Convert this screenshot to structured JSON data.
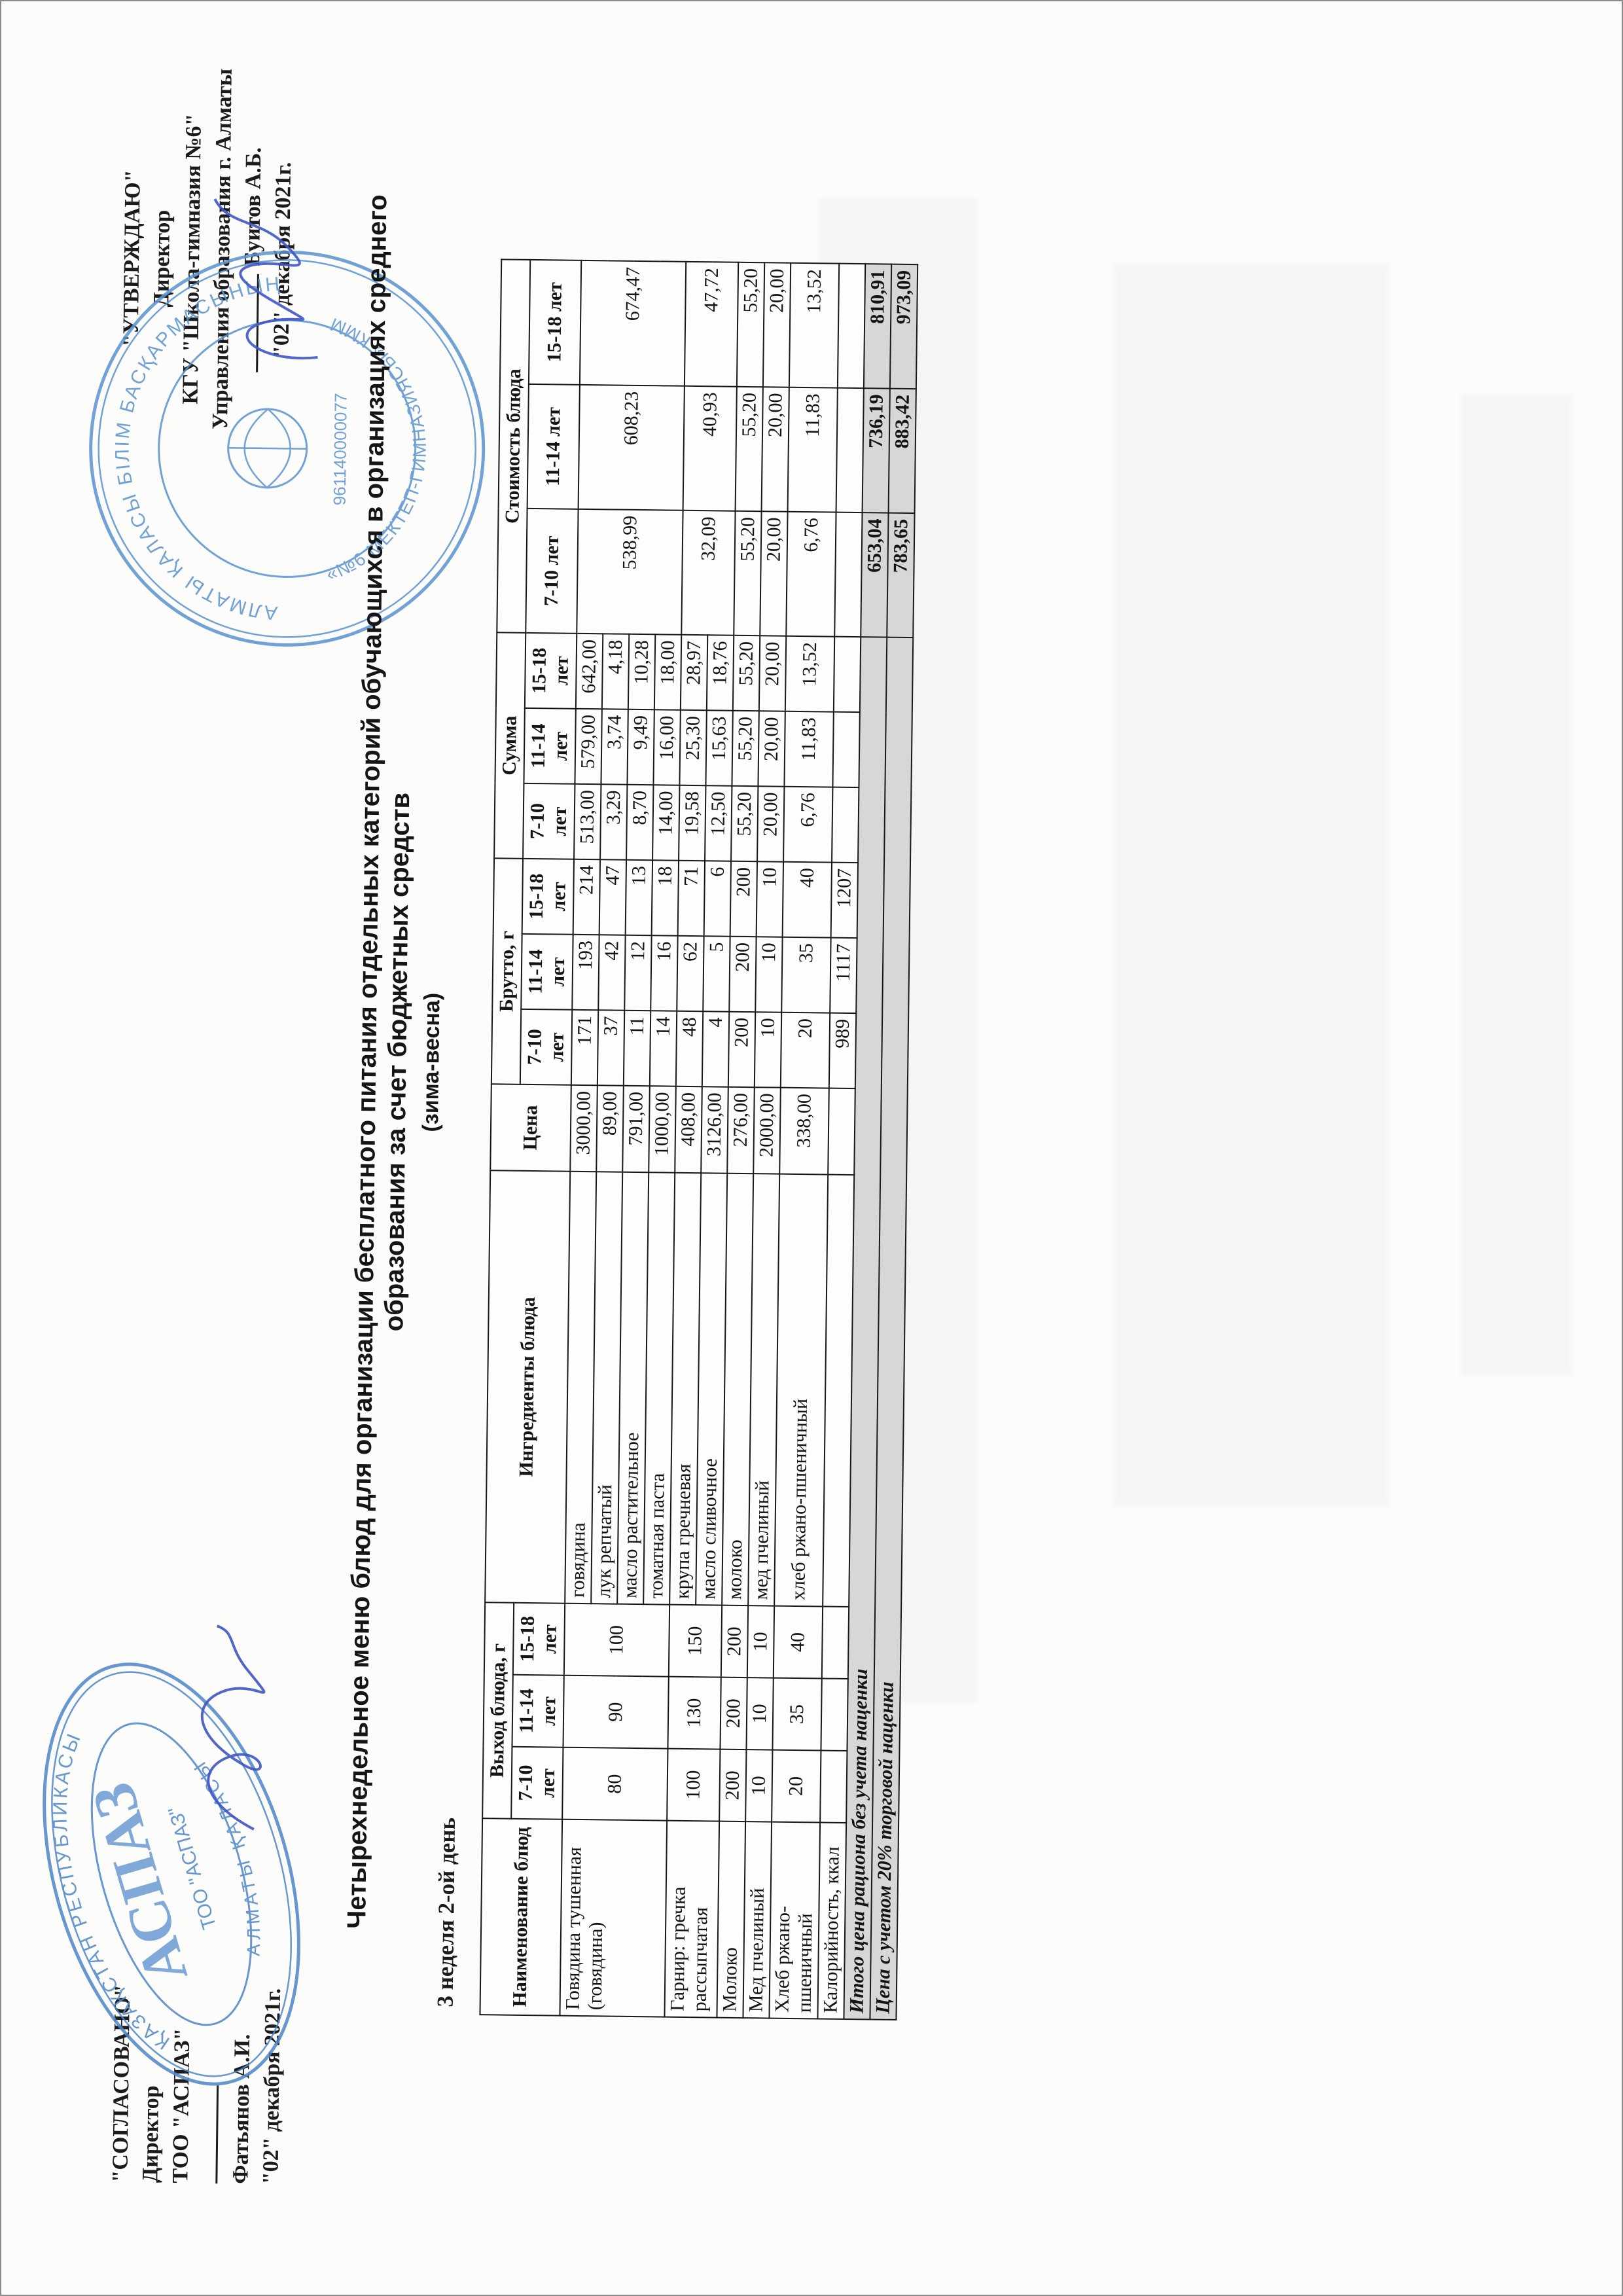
{
  "approval_left": {
    "title": "\"СОГЛАСОВАНО\"",
    "role": "Директор",
    "org": "ТОО \"АСПАЗ\"",
    "name": "Фатьянов А.И.",
    "date": "\"02\" декабря 2021г."
  },
  "approval_right": {
    "title": "\"УТВЕРЖДАЮ\"",
    "role": "Директор",
    "org": "КГУ \"Школа-гимназия №6\"",
    "org2": "Управления образования г. Алматы",
    "name": "Буитов А.Б.",
    "date": "\"02\" декабря 2021г."
  },
  "stamp_left": {
    "ring_top": "ҚАЗАҚСТАН РЕСПУБЛИКАСЫ",
    "ring_bottom": "АЛМАТЫ ҚАЛАСЫ",
    "center": "АСПАЗ",
    "inner": "ТОО \"АСПАЗ\""
  },
  "stamp_right": {
    "ring_top": "АЛМАТЫ ҚАЛАСЫ БІЛІМ БАСҚАРМАСЫНЫҢ",
    "ring_bottom": "«№6 МЕКТЕП-ГИМНАЗИЯСЫ» КММ",
    "center": "961140000077"
  },
  "title_line1": "Четырехнедельное меню блюд для организации бесплатного питания отдельных категорий обучающихся в организациях среднего образования за счет бюджетных средств",
  "title_line2": "(зима-весна)",
  "subtitle": "3 неделя 2-ой день",
  "table": {
    "groups": [
      {
        "label": "Наименование блюд",
        "merged": true
      },
      {
        "label": "Выход блюда, г",
        "sub": [
          "7-10 лет",
          "11-14 лет",
          "15-18 лет"
        ]
      },
      {
        "label": "Ингредиенты блюда",
        "merged": true
      },
      {
        "label": "Цена",
        "merged": true
      },
      {
        "label": "Брутто, г",
        "sub": [
          "7-10 лет",
          "11-14 лет",
          "15-18 лет"
        ]
      },
      {
        "label": "Сумма",
        "sub": [
          "7-10 лет",
          "11-14 лет",
          "15-18 лет"
        ]
      },
      {
        "label": "Стоимость блюда",
        "sub": [
          "7-10 лет",
          "11-14 лет",
          "15-18 лет"
        ]
      }
    ],
    "rows": [
      {
        "dish": "Говядина тушенная (говядина)",
        "span": 4,
        "out": [
          "80",
          "90",
          "100"
        ],
        "cost": [
          "538,99",
          "608,23",
          "674,47"
        ],
        "ing": "говядина",
        "price": "3000,00",
        "gross": [
          "171",
          "193",
          "214"
        ],
        "sum": [
          "513,00",
          "579,00",
          "642,00"
        ]
      },
      {
        "ing": "лук репчатый",
        "price": "89,00",
        "gross": [
          "37",
          "42",
          "47"
        ],
        "sum": [
          "3,29",
          "3,74",
          "4,18"
        ]
      },
      {
        "ing": "масло растительное",
        "price": "791,00",
        "gross": [
          "11",
          "12",
          "13"
        ],
        "sum": [
          "8,70",
          "9,49",
          "10,28"
        ]
      },
      {
        "ing": "томатная паста",
        "price": "1000,00",
        "gross": [
          "14",
          "16",
          "18"
        ],
        "sum": [
          "14,00",
          "16,00",
          "18,00"
        ]
      },
      {
        "dish": "Гарнир: гречка рассыпчатая",
        "span": 2,
        "out": [
          "100",
          "130",
          "150"
        ],
        "cost": [
          "32,09",
          "40,93",
          "47,72"
        ],
        "ing": "крупа гречневая",
        "price": "408,00",
        "gross": [
          "48",
          "62",
          "71"
        ],
        "sum": [
          "19,58",
          "25,30",
          "28,97"
        ]
      },
      {
        "ing": "масло сливочное",
        "price": "3126,00",
        "gross": [
          "4",
          "5",
          "6"
        ],
        "sum": [
          "12,50",
          "15,63",
          "18,76"
        ]
      },
      {
        "dish": "Молоко",
        "span": 1,
        "out": [
          "200",
          "200",
          "200"
        ],
        "cost": [
          "55,20",
          "55,20",
          "55,20"
        ],
        "ing": "молоко",
        "price": "276,00",
        "gross": [
          "200",
          "200",
          "200"
        ],
        "sum": [
          "55,20",
          "55,20",
          "55,20"
        ]
      },
      {
        "dish": "Мед пчелиный",
        "span": 1,
        "out": [
          "10",
          "10",
          "10"
        ],
        "cost": [
          "20,00",
          "20,00",
          "20,00"
        ],
        "ing": "мед пчелиный",
        "price": "2000,00",
        "gross": [
          "10",
          "10",
          "10"
        ],
        "sum": [
          "20,00",
          "20,00",
          "20,00"
        ]
      },
      {
        "dish": "Хлеб ржано-пшеничный",
        "span": 1,
        "out": [
          "20",
          "35",
          "40"
        ],
        "cost": [
          "6,76",
          "11,83",
          "13,52"
        ],
        "ing": "хлеб ржано-пшеничный",
        "price": "338,00",
        "gross": [
          "20",
          "35",
          "40"
        ],
        "sum": [
          "6,76",
          "11,83",
          "13,52"
        ]
      },
      {
        "dish": "Калорийность, ккал",
        "span": 1,
        "out": [
          "",
          "",
          ""
        ],
        "cost": [
          "",
          "",
          ""
        ],
        "ing": "",
        "price": "",
        "gross": [
          "989",
          "1117",
          "1207"
        ],
        "sum": [
          "",
          "",
          ""
        ]
      }
    ],
    "totals": [
      {
        "label": "Итого цена рациона без учета наценки",
        "values": [
          "653,04",
          "736,19",
          "810,91"
        ]
      },
      {
        "label": "Цена с учетом 20% торговой наценки",
        "values": [
          "783,65",
          "883,42",
          "973,09"
        ]
      }
    ]
  }
}
